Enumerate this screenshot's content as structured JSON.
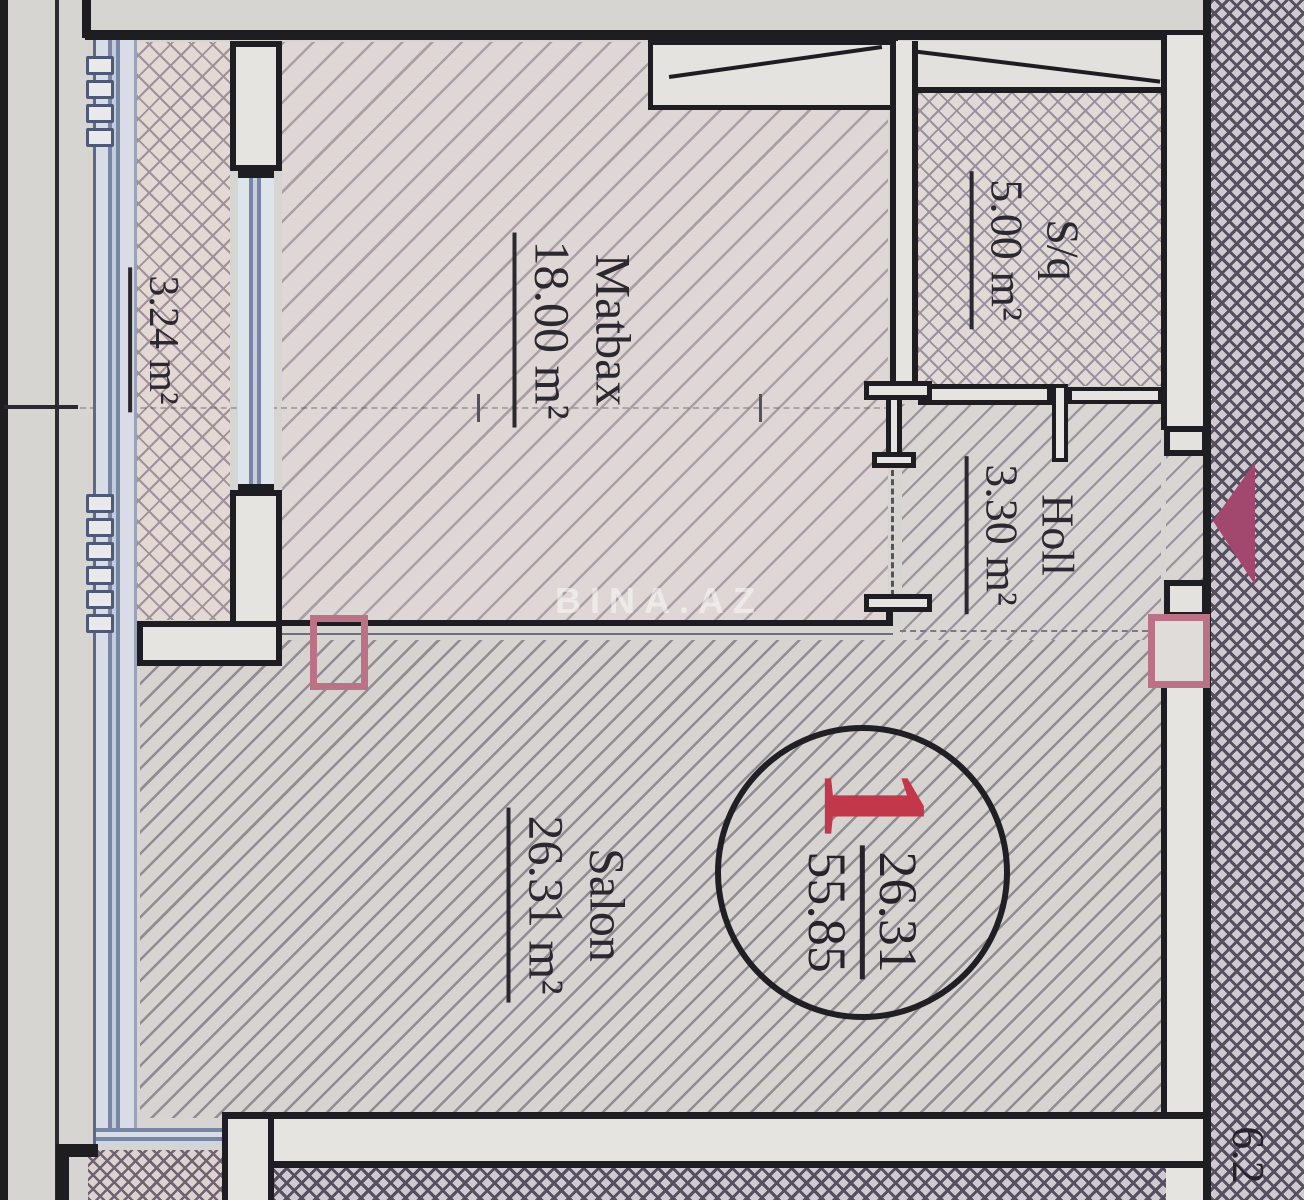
{
  "rooms": {
    "balcony": {
      "area": "3.24 m²"
    },
    "kitchen": {
      "name": "Matbax",
      "area": "18.00 m²"
    },
    "bathroom": {
      "name": "S/q",
      "area": "5.00 m²"
    },
    "hall": {
      "name": "Holl",
      "area": "3.30 m²"
    },
    "salon": {
      "name": "Salon",
      "area": "26.31 m²"
    }
  },
  "unit_badge": {
    "number": "1",
    "upper_value": "26.31",
    "lower_value": "55.85"
  },
  "adjacent_unit_label": "6.2",
  "watermark": "BINA.AZ",
  "colors": {
    "accent_red": "#c23749",
    "column_marker_pink": "#bb7186",
    "entrance_arrow_magenta": "#a2486e",
    "window_blue": "#7885a3",
    "wall_black": "#1d1d22"
  }
}
